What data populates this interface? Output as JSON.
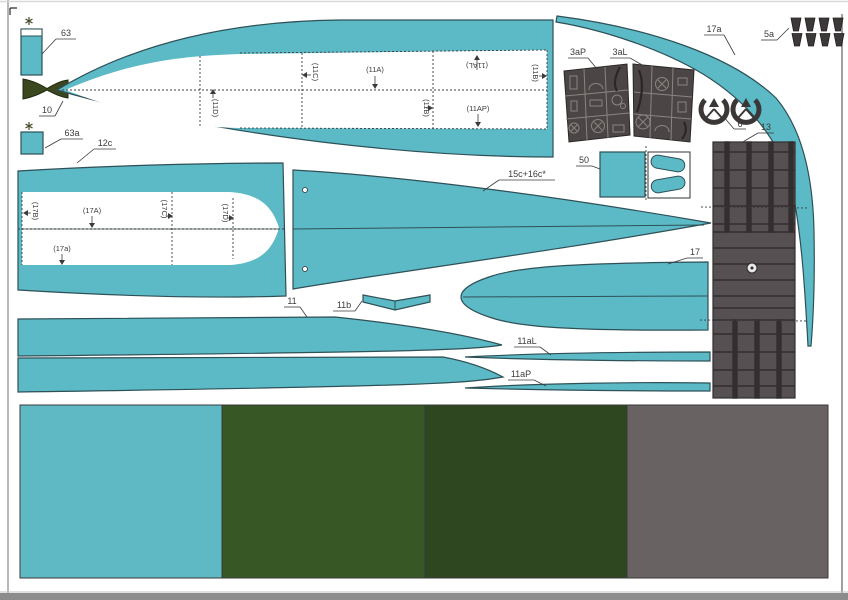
{
  "sheet": {
    "labels": {
      "p63": "63",
      "p10": "10",
      "p63a": "63a",
      "p12c": "12c",
      "s11D": "(11D)",
      "s11C": "(11C)",
      "s11A": "(11A)",
      "s11AL": "(11AL)",
      "s11B_right": "(11B)",
      "s11B_mid": "(11B)",
      "s11AP": "(11AP)",
      "s17B": "(17B)",
      "s17A": "(17A)",
      "s17C": "(17C)",
      "s17D": "(17D)",
      "s17a": "(17a)",
      "p15c16c": "15c+16c*",
      "p17a": "17a",
      "p5a": "5a",
      "p3aP": "3aP",
      "p3aL": "3aL",
      "p6": "6",
      "p13": "13",
      "p50": "50",
      "p17": "17",
      "p11": "11",
      "p11b": "11b",
      "p11aL": "11aL",
      "p11aP": "11aP"
    },
    "swatches": [
      {
        "name": "teal",
        "color": "#5FB9C4"
      },
      {
        "name": "olive-green",
        "color": "#375724"
      },
      {
        "name": "dark-green",
        "color": "#2E4721"
      },
      {
        "name": "gray",
        "color": "#696263"
      }
    ],
    "part_colors": {
      "teal_fill": "#5CBAC6",
      "teal_stroke": "#2E5057",
      "olive_dark": "#3B471E",
      "panel_gray": "#4B4645",
      "column_gray": "#575052"
    }
  }
}
